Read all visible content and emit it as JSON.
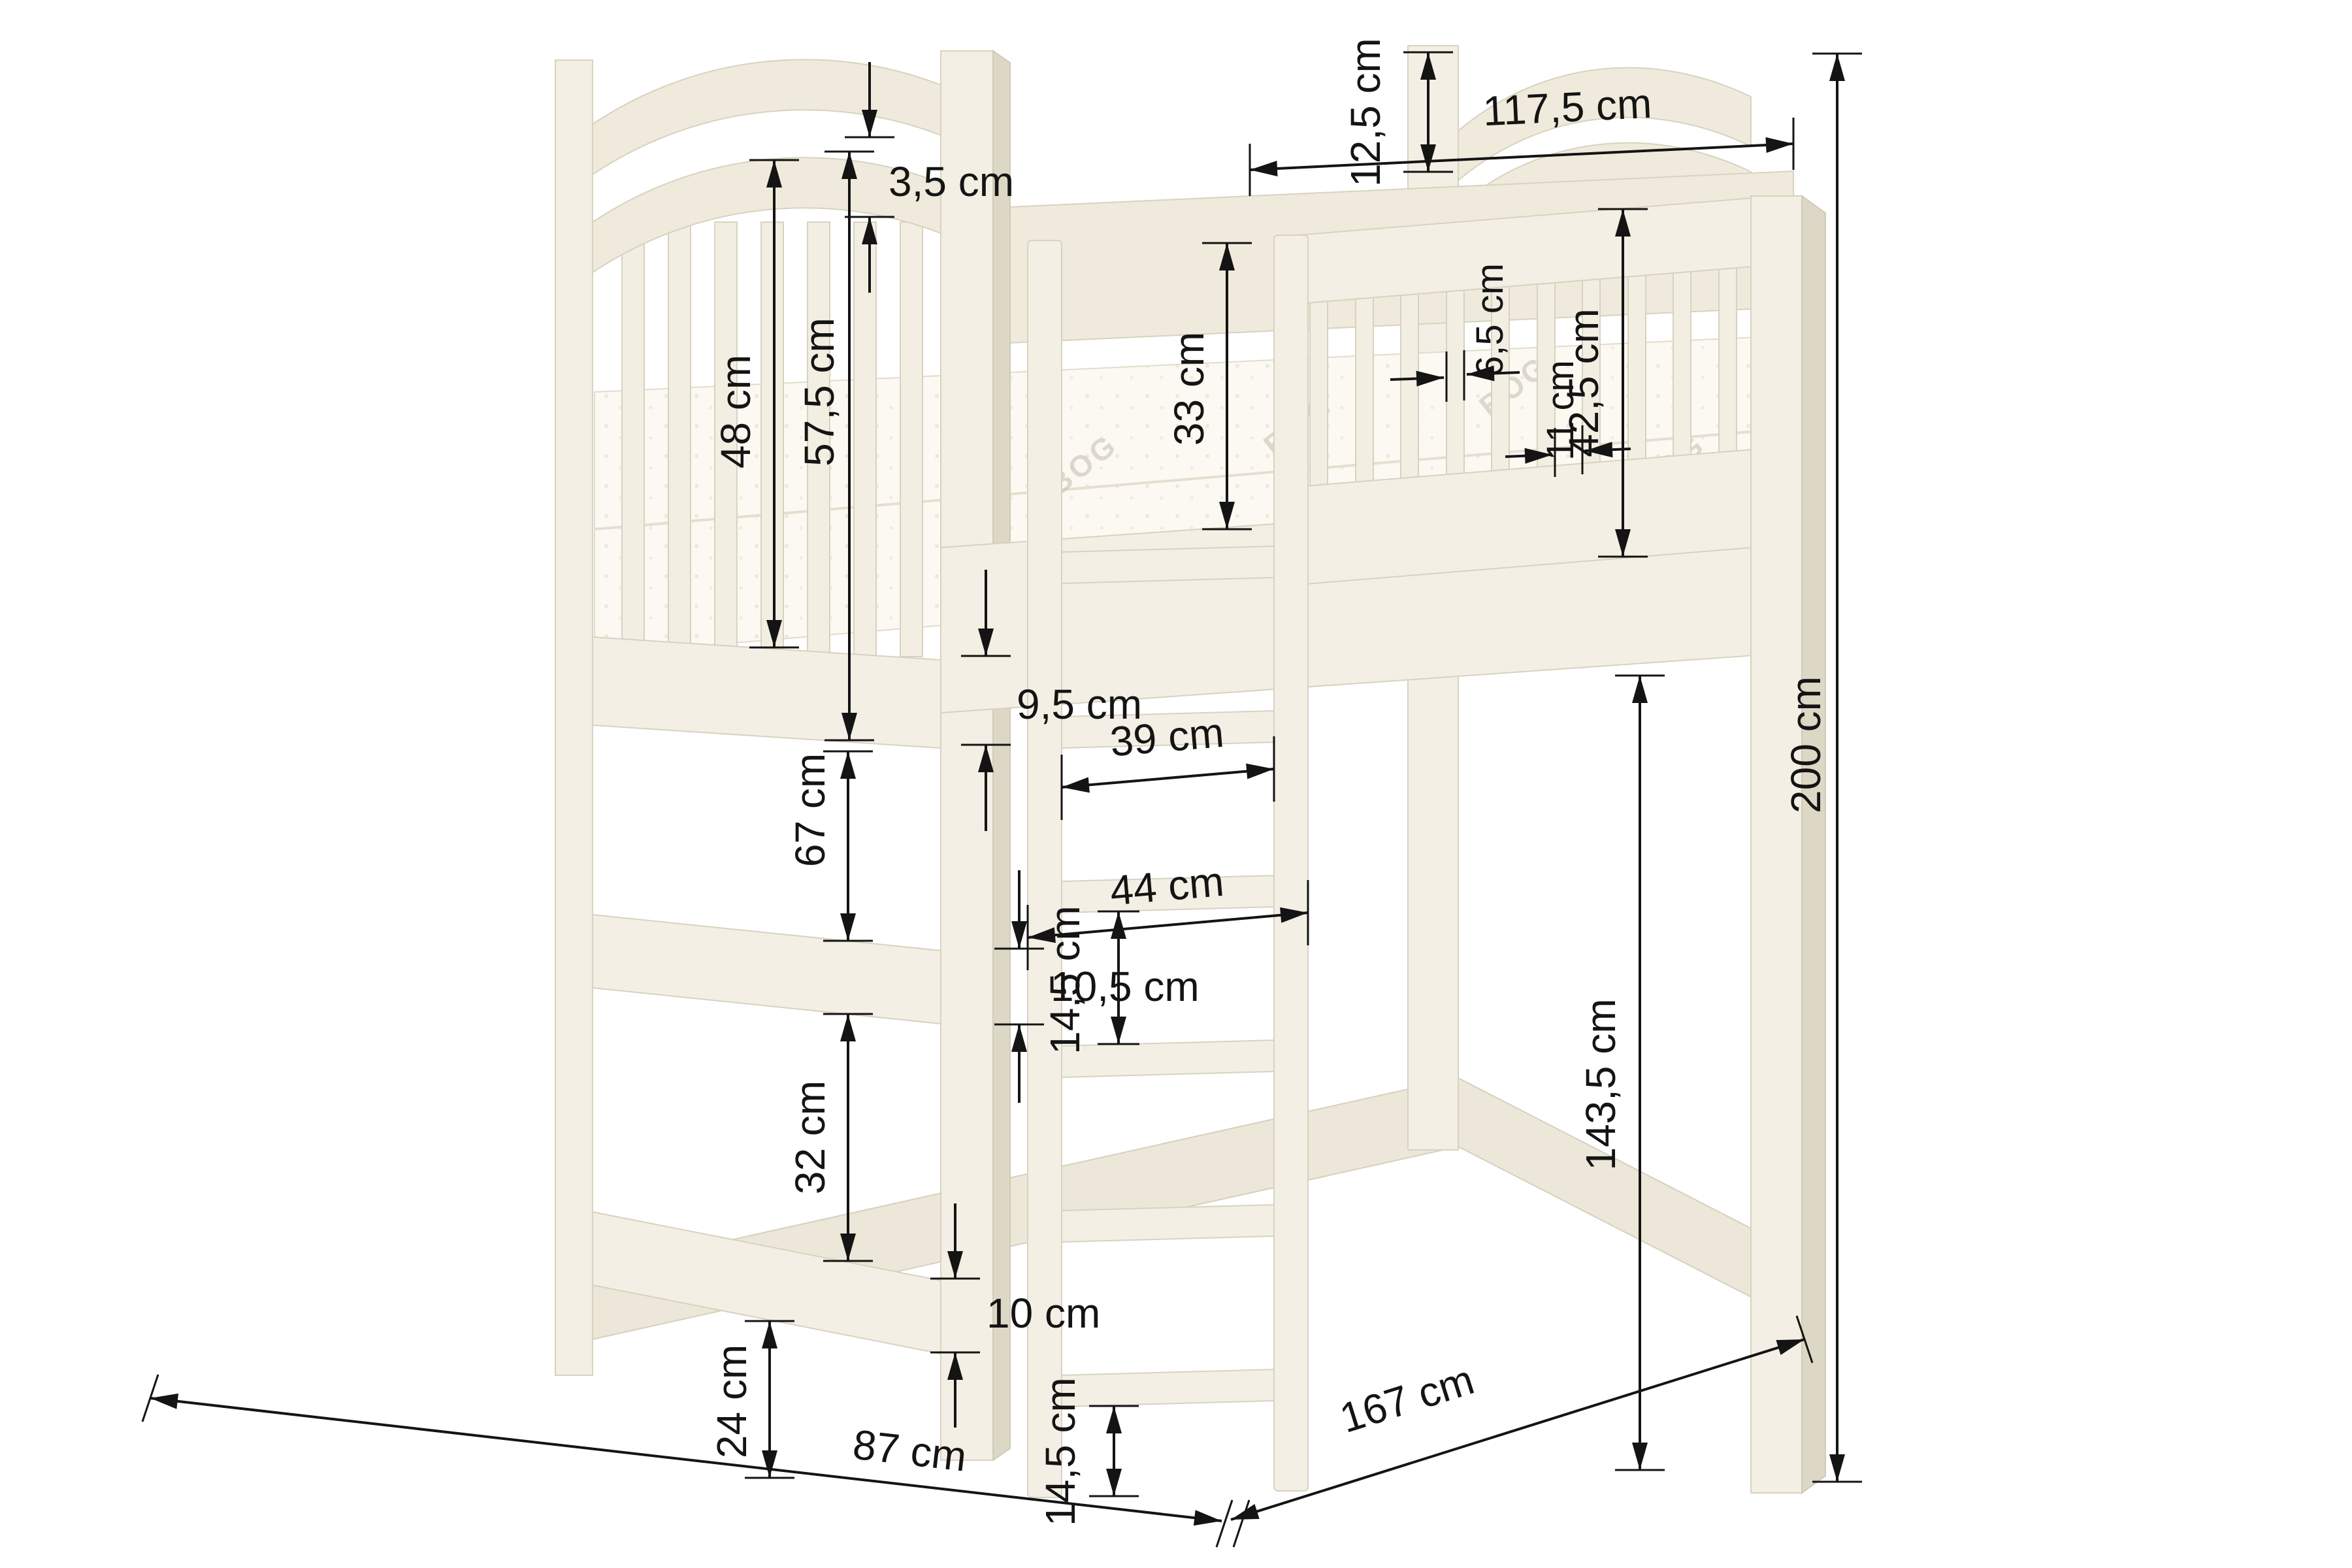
{
  "dimensions": {
    "arch_gap": "3,5 cm",
    "headboard_slat_height": "48 cm",
    "headboard_panel_height": "57,5 cm",
    "headboard_rail_height": "9,5 cm",
    "upper_rail_gap": "67 cm",
    "mid_rail_height": "10,5 cm",
    "lower_rail_gap": "32 cm",
    "low_rail_height": "10 cm",
    "floor_clearance": "24 cm",
    "guard_height_above_mattress": "33 cm",
    "guard_slat_width": "6,5 cm",
    "guard_slat_gap": "11 cm",
    "guardrail_height": "42,5 cm",
    "post_above_arch": "12,5 cm",
    "guard_panel_length": "117,5 cm",
    "ladder_inner_width": "39 cm",
    "ladder_outer_width": "44 cm",
    "rung_gap": "14,5 cm",
    "rung_gap_bottom": "14,5 cm",
    "underbed_height": "143,5 cm",
    "total_height": "200 cm",
    "total_length": "167 cm",
    "total_width": "87 cm"
  },
  "mattress": {
    "watermark": "BOG"
  },
  "colors": {
    "background": "#ffffff",
    "wood": "#f3efe4",
    "wood_shade": "#e9e4d5",
    "wood_dark": "#ddd7c5",
    "outline": "#d8d2c0",
    "dimension_ink": "#141414",
    "mattress": "#fbf9f2"
  }
}
